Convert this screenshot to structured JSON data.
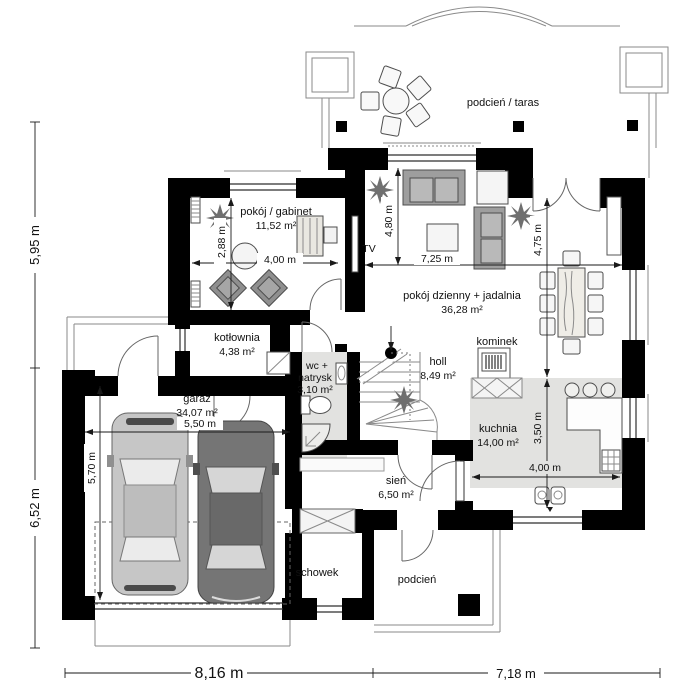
{
  "rooms": {
    "terrace": {
      "name": "podcień / taras"
    },
    "office": {
      "name": "pokój / gabinet",
      "area": "11,52 m²"
    },
    "living": {
      "name": "pokój dzienny + jadalnia",
      "area": "36,28 m²"
    },
    "boiler": {
      "name": "kotłownia",
      "area": "4,38 m²"
    },
    "wc": {
      "name1": "wc +",
      "name2": "natrysk",
      "area": "3,10 m²"
    },
    "hall": {
      "name": "holl",
      "area": "8,49 m²"
    },
    "fireplace": {
      "name": "kominek"
    },
    "kitchen": {
      "name": "kuchnia",
      "area": "14,00 m²"
    },
    "garage": {
      "name": "garaż",
      "area": "34,07 m²"
    },
    "vestibule": {
      "name": "sień",
      "area": "6,50 m²"
    },
    "storage": {
      "name": "schowek"
    },
    "porch": {
      "name": "podcień"
    }
  },
  "labels": {
    "tv": "TV"
  },
  "dims": {
    "office_w": "4,00 m",
    "office_h": "2,88 m",
    "living_w": "7,25 m",
    "living_h": "4,80 m",
    "dining_h": "4,75 m",
    "kitchen_w": "4,00 m",
    "kitchen_h": "3,50 m",
    "garage_w": "5,50 m",
    "garage_h": "5,70 m",
    "total_left_top": "5,95 m",
    "total_left_bottom": "6,52 m",
    "total_bottom_left": "8,16 m",
    "total_bottom_right": "7,18 m"
  }
}
